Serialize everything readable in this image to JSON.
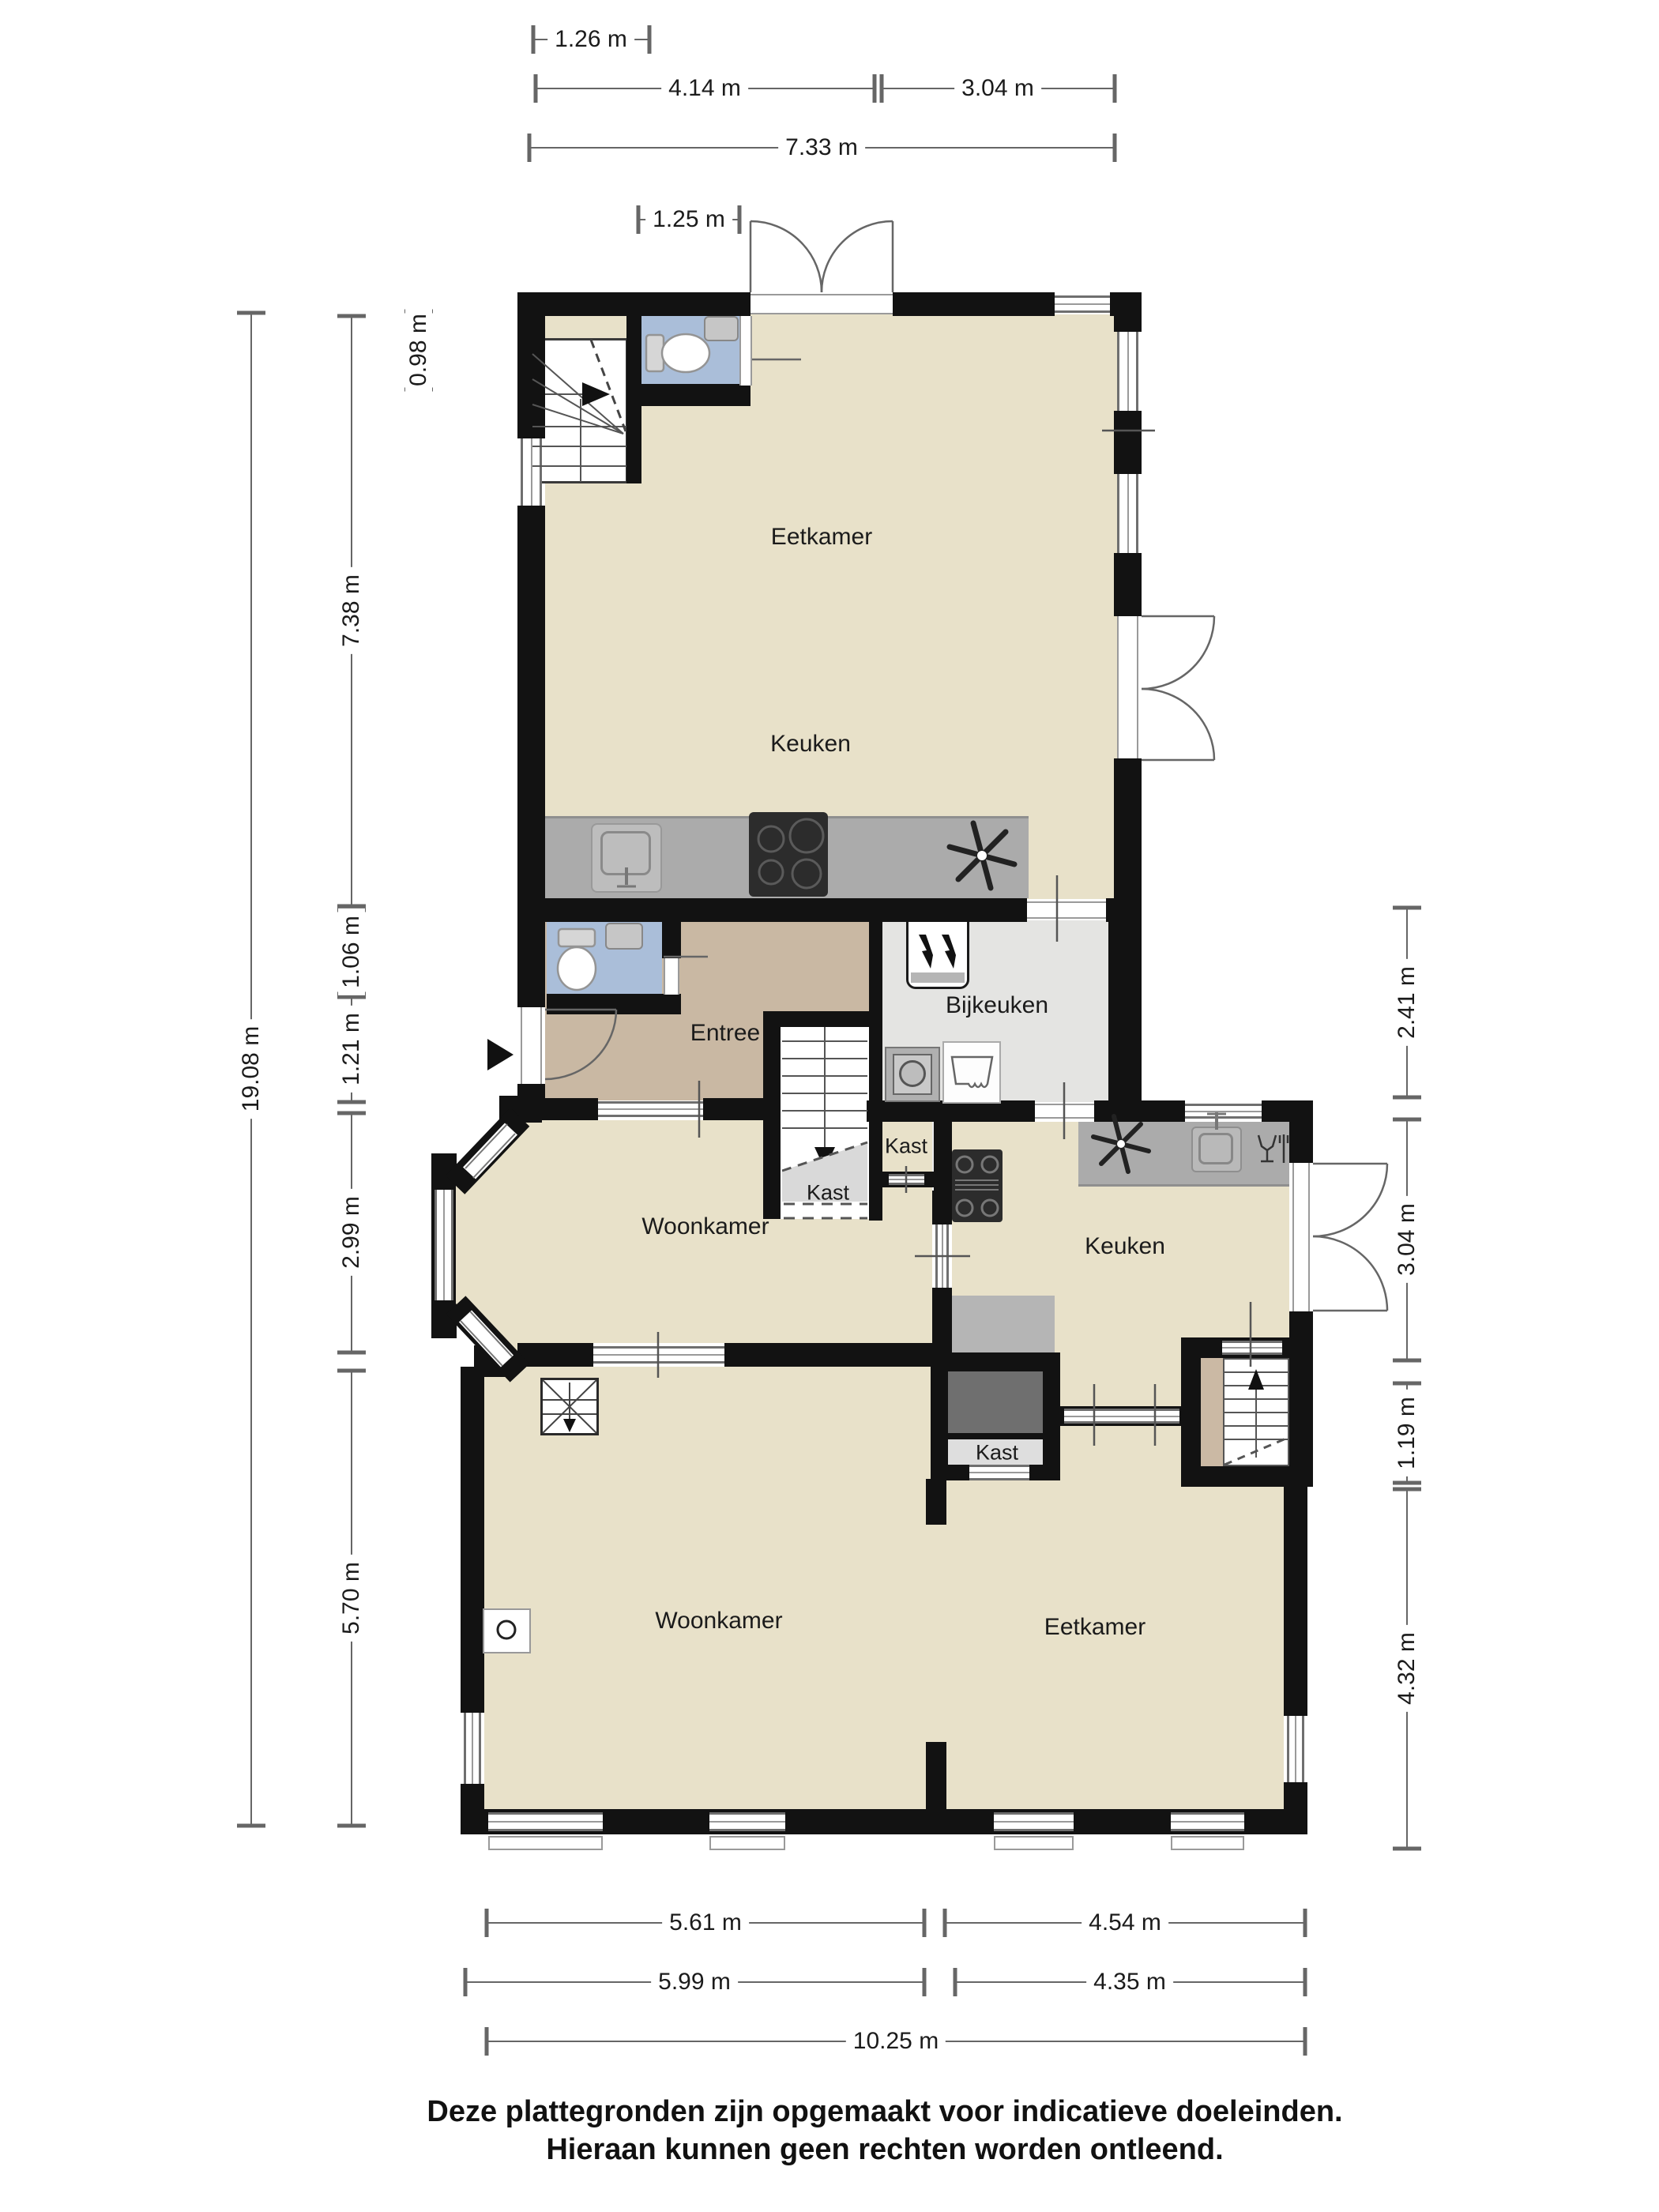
{
  "rooms": {
    "eetkamer_top": "Eetkamer",
    "keuken_top": "Keuken",
    "entree": "Entree",
    "bijkeuken": "Bijkeuken",
    "kast_side": "Kast",
    "kast_understairs": "Kast",
    "woonkamer_mid": "Woonkamer",
    "keuken_mid": "Keuken",
    "kast_mid": "Kast",
    "woonkamer_bottom": "Woonkamer",
    "eetkamer_bottom": "Eetkamer"
  },
  "dims": {
    "t1": "1.26 m",
    "t2": "4.14 m",
    "t3": "3.04 m",
    "t4": "7.33 m",
    "t5": "1.25 m",
    "l1": "0.98 m",
    "l2": "7.38 m",
    "l3": "1.06 m",
    "l4": "1.21 m",
    "l5": "2.99 m",
    "l6": "5.70 m",
    "l7": "19.08 m",
    "r1": "2.41 m",
    "r2": "3.04 m",
    "r3": "1.19 m",
    "r4": "4.32 m",
    "b1": "5.61 m",
    "b2": "4.54 m",
    "b3": "5.99 m",
    "b4": "4.35 m",
    "b5": "10.25 m"
  },
  "disclaimer": {
    "line1": "Deze plattegronden zijn opgemaakt voor indicatieve doeleinden.",
    "line2": "Hieraan kunnen geen rechten worden ontleend."
  },
  "colors": {
    "floor": "#e8e1c9",
    "floor_entree": "#c9b8a3",
    "floor_utility": "#e4e4e2",
    "wc_blue": "#aabed9",
    "counter_gray": "#ababab",
    "wall_black": "#121212",
    "kast_dark": "#6f6f6f"
  }
}
